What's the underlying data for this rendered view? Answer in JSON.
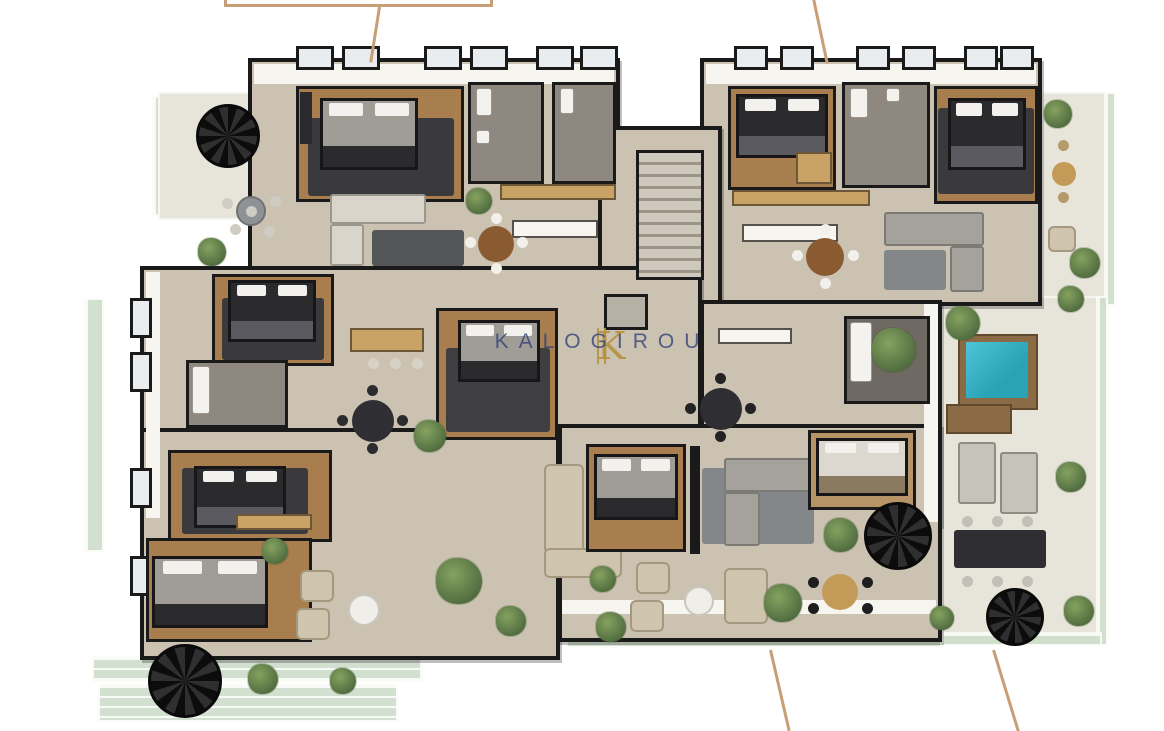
{
  "page": {
    "background": "#ffffff"
  },
  "watermark": {
    "monogram": "K",
    "text": "KALOGIROU"
  },
  "palette": {
    "wall": "#1a1a1a",
    "concrete": "#cbc2b2",
    "white_wall": "#f7f5f0",
    "window": "#e9edf0",
    "wood": "#a87e4e",
    "wood_light": "#c9a266",
    "tile": "#8e8880",
    "tile_dark": "#6e6963",
    "terrace": "#e7e5da",
    "glass": "#cfdecb",
    "rug_dark": "#3a3a3d",
    "rug_gray": "#84878a",
    "sofa_light": "#d9d5cb",
    "sofa_gray": "#a5a29b",
    "bed_dark": "#2b2b2e",
    "bed_gray": "#a09d96",
    "table_wood": "#8a5a30",
    "table_tan": "#c49a58",
    "pool_water": "#2aa3b7",
    "pool_deck": "#8a6b45",
    "plant": "#5d7a48",
    "plant_dark": "#465f36",
    "callout": "#c89e76",
    "watermark_text": "#2e4077",
    "watermark_gold": "#b8923d"
  }
}
